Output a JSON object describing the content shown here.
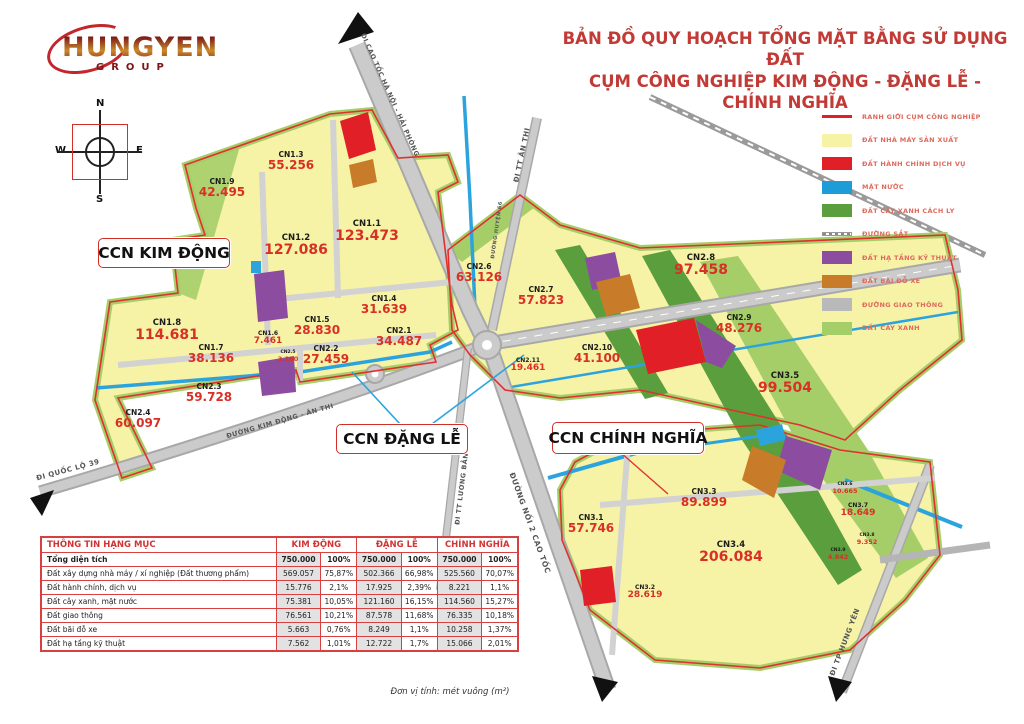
{
  "logo": {
    "brand": "HUNGYEN",
    "sub": "GROUP"
  },
  "title": {
    "line1": "BẢN ĐỒ QUY HOẠCH TỔNG MẶT BẰNG SỬ DỤNG ĐẤT",
    "line2": "CỤM CÔNG NGHIỆP KIM ĐỘNG - ĐẶNG LỄ - CHÍNH NGHĨA"
  },
  "compass": {
    "n": "N",
    "e": "E",
    "s": "S",
    "w": "W"
  },
  "map": {
    "clusters": [
      {
        "label": "CCN KIM ĐỘNG",
        "x": 98,
        "y": 238,
        "w": 132,
        "h": 30
      },
      {
        "label": "CCN ĐẶNG LỄ",
        "x": 336,
        "y": 424,
        "w": 132,
        "h": 30
      },
      {
        "label": "CCN CHÍNH NGHĨA",
        "x": 552,
        "y": 422,
        "w": 152,
        "h": 32
      }
    ],
    "parcels": [
      {
        "id": "CN1.9",
        "value": "42.495",
        "x": 222,
        "y": 188,
        "size": "md"
      },
      {
        "id": "CN1.3",
        "value": "55.256",
        "x": 291,
        "y": 161,
        "size": "md"
      },
      {
        "id": "CN1.2",
        "value": "127.086",
        "x": 296,
        "y": 246,
        "size": "lg"
      },
      {
        "id": "CN1.1",
        "value": "123.473",
        "x": 367,
        "y": 232,
        "size": "lg"
      },
      {
        "id": "CN1.4",
        "value": "31.639",
        "x": 384,
        "y": 305,
        "size": "md"
      },
      {
        "id": "CN1.5",
        "value": "28.830",
        "x": 317,
        "y": 326,
        "size": "md"
      },
      {
        "id": "CN1.6",
        "value": "7.461",
        "x": 268,
        "y": 339,
        "size": "sm"
      },
      {
        "id": "CN2.1",
        "value": "34.487",
        "x": 399,
        "y": 337,
        "size": "md"
      },
      {
        "id": "CN1.8",
        "value": "114.681",
        "x": 167,
        "y": 331,
        "size": "lg"
      },
      {
        "id": "CN1.7",
        "value": "38.136",
        "x": 211,
        "y": 354,
        "size": "md"
      },
      {
        "id": "CN2.2",
        "value": "27.459",
        "x": 326,
        "y": 355,
        "size": "md"
      },
      {
        "id": "CN2.5",
        "value": "3.180",
        "x": 288,
        "y": 357,
        "size": "xs"
      },
      {
        "id": "CN2.3",
        "value": "59.728",
        "x": 209,
        "y": 393,
        "size": "md"
      },
      {
        "id": "CN2.4",
        "value": "60.097",
        "x": 138,
        "y": 419,
        "size": "md"
      },
      {
        "id": "CN2.6",
        "value": "63.126",
        "x": 479,
        "y": 273,
        "size": "md"
      },
      {
        "id": "CN2.7",
        "value": "57.823",
        "x": 541,
        "y": 296,
        "size": "md"
      },
      {
        "id": "CN2.8",
        "value": "97.458",
        "x": 701,
        "y": 266,
        "size": "lg"
      },
      {
        "id": "CN2.9",
        "value": "48.276",
        "x": 739,
        "y": 324,
        "size": "md"
      },
      {
        "id": "CN2.10",
        "value": "41.100",
        "x": 597,
        "y": 354,
        "size": "md"
      },
      {
        "id": "CN2.11",
        "value": "19.461",
        "x": 528,
        "y": 366,
        "size": "sm"
      },
      {
        "id": "CN3.5",
        "value": "99.504",
        "x": 785,
        "y": 384,
        "size": "lg"
      },
      {
        "id": "CN3.1",
        "value": "57.746",
        "x": 591,
        "y": 524,
        "size": "md"
      },
      {
        "id": "CN3.3",
        "value": "89.899",
        "x": 704,
        "y": 498,
        "size": "md"
      },
      {
        "id": "CN3.4",
        "value": "206.084",
        "x": 731,
        "y": 553,
        "size": "lg"
      },
      {
        "id": "CN3.2",
        "value": "28.619",
        "x": 645,
        "y": 593,
        "size": "sm"
      },
      {
        "id": "CN3.6",
        "value": "10.665",
        "x": 845,
        "y": 489,
        "size": "xs"
      },
      {
        "id": "CN3.7",
        "value": "18.649",
        "x": 858,
        "y": 511,
        "size": "sm"
      },
      {
        "id": "CN3.8",
        "value": "9.352",
        "x": 867,
        "y": 540,
        "size": "xs"
      },
      {
        "id": "CN3.9",
        "value": "4.842",
        "x": 838,
        "y": 555,
        "size": "xs"
      }
    ],
    "road_labels": [
      {
        "label": "ĐI CAO TỐC HÀ NỘI - HẢI PHÒNG",
        "x": 390,
        "y": 95,
        "rot": 66,
        "fs": 6.5
      },
      {
        "label": "ĐI TT ÂN THI",
        "x": 522,
        "y": 155,
        "rot": -78,
        "fs": 7
      },
      {
        "label": "ĐƯỜNG HUYỆN 66",
        "x": 497,
        "y": 230,
        "rot": -82,
        "fs": 5
      },
      {
        "label": "ĐI QUỐC LỘ 39",
        "x": 68,
        "y": 470,
        "rot": -15,
        "fs": 7
      },
      {
        "label": "ĐƯỜNG KIM ĐỘNG - ÂN THI",
        "x": 280,
        "y": 421,
        "rot": -16,
        "fs": 6.5
      },
      {
        "label": "ĐI TT LƯƠNG BẰNG",
        "x": 462,
        "y": 486,
        "rot": -83,
        "fs": 6.5
      },
      {
        "label": "ĐƯỜNG NỐI 2 CAO TỐC",
        "x": 530,
        "y": 523,
        "rot": 70,
        "fs": 7.5
      },
      {
        "label": "ĐI TP HƯNG YÊN",
        "x": 845,
        "y": 642,
        "rot": -69,
        "fs": 7
      }
    ]
  },
  "legend": {
    "items": [
      {
        "label": "RANH GIỚI CỤM CÔNG NGHIỆP",
        "type": "line",
        "color": "#e01f26"
      },
      {
        "label": "ĐẤT NHÀ MÁY SẢN XUẤT",
        "type": "fill",
        "color": "#f6f2a6"
      },
      {
        "label": "ĐẤT HÀNH CHÍNH DỊCH VỤ",
        "type": "fill",
        "color": "#e01f26"
      },
      {
        "label": "MẶT NƯỚC",
        "type": "fill",
        "color": "#1d9cd8"
      },
      {
        "label": "ĐẤT CÂY XANH CÁCH LY",
        "type": "fill",
        "color": "#5b9e3d"
      },
      {
        "label": "ĐƯỜNG SẮT",
        "type": "rail",
        "color": "#8a8a8a"
      },
      {
        "label": "ĐẤT HẠ TẦNG KỸ THUẬT",
        "type": "fill",
        "color": "#8c4ca0"
      },
      {
        "label": "ĐẤT BÃI ĐỖ XE",
        "type": "fill",
        "color": "#c87b28"
      },
      {
        "label": "ĐƯỜNG GIAO THÔNG",
        "type": "fill",
        "color": "#b9b9b9"
      },
      {
        "label": "ĐẤT CÂY XANH",
        "type": "fill",
        "color": "#a5ce69"
      }
    ]
  },
  "table": {
    "col_header": "THÔNG TIN HẠNG MỤC",
    "groups": [
      "KIM ĐỘNG",
      "ĐẶNG LỄ",
      "CHÍNH NGHĨA"
    ],
    "rows": [
      {
        "label": "Tổng diện tích",
        "bold": true,
        "cells": [
          "750.000",
          "100%",
          "750.000",
          "100%",
          "750.000",
          "100%"
        ]
      },
      {
        "label": "Đất xây dựng nhà máy / xí nghiệp (Đất thương phẩm)",
        "bold": false,
        "cells": [
          "569.057",
          "75,87%",
          "502.366",
          "66,98%",
          "525.560",
          "70,07%"
        ]
      },
      {
        "label": "Đất hành chính, dịch vụ",
        "bold": false,
        "cells": [
          "15.776",
          "2,1%",
          "17.925",
          "2,39%",
          "8.221",
          "1,1%"
        ]
      },
      {
        "label": "Đất cây xanh, mặt nước",
        "bold": false,
        "cells": [
          "75.381",
          "10,05%",
          "121.160",
          "16,15%",
          "114.560",
          "15,27%"
        ]
      },
      {
        "label": "Đất giao thông",
        "bold": false,
        "cells": [
          "76.561",
          "10,21%",
          "87.578",
          "11,68%",
          "76.335",
          "10,18%"
        ]
      },
      {
        "label": "Đất bãi đỗ xe",
        "bold": false,
        "cells": [
          "5.663",
          "0,76%",
          "8.249",
          "1,1%",
          "10.258",
          "1,37%"
        ]
      },
      {
        "label": "Đất hạ tầng kỹ thuật",
        "bold": false,
        "cells": [
          "7.562",
          "1,01%",
          "12.722",
          "1,7%",
          "15.066",
          "2,01%"
        ]
      }
    ]
  },
  "footer": {
    "note": "Đơn vị tính: mét vuông (m²)"
  }
}
